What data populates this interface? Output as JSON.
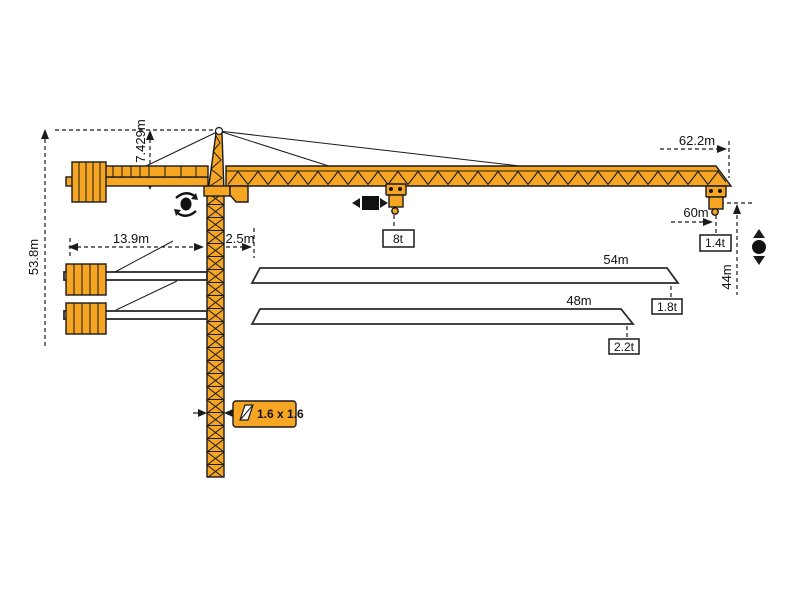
{
  "diagram": {
    "title": "tower-crane-working-range-diagram",
    "colors": {
      "crane_orange": "#F6A623",
      "line_black": "#1a1a1a",
      "background": "#ffffff"
    },
    "labels": {
      "jib_radius_max": "62.2m",
      "total_height": "53.8m",
      "head_height": "7.429m",
      "counter_jib_length": "13.9m",
      "min_radius": "2.5m",
      "max_load": "8t",
      "tip_radius": "60m",
      "tip_load_62": "1.4t",
      "hook_drop": "44m",
      "jib_variant_54": "54m",
      "tip_load_54": "1.8t",
      "jib_variant_48": "48m",
      "tip_load_48": "2.2t",
      "mast_section": "1.6 x 1.6"
    },
    "icons": {
      "slew": "rotation-circle",
      "trolley_travel": "square-left-right-arrows",
      "hoist": "circle-up-down-arrows",
      "mast_section": "section-square"
    }
  }
}
